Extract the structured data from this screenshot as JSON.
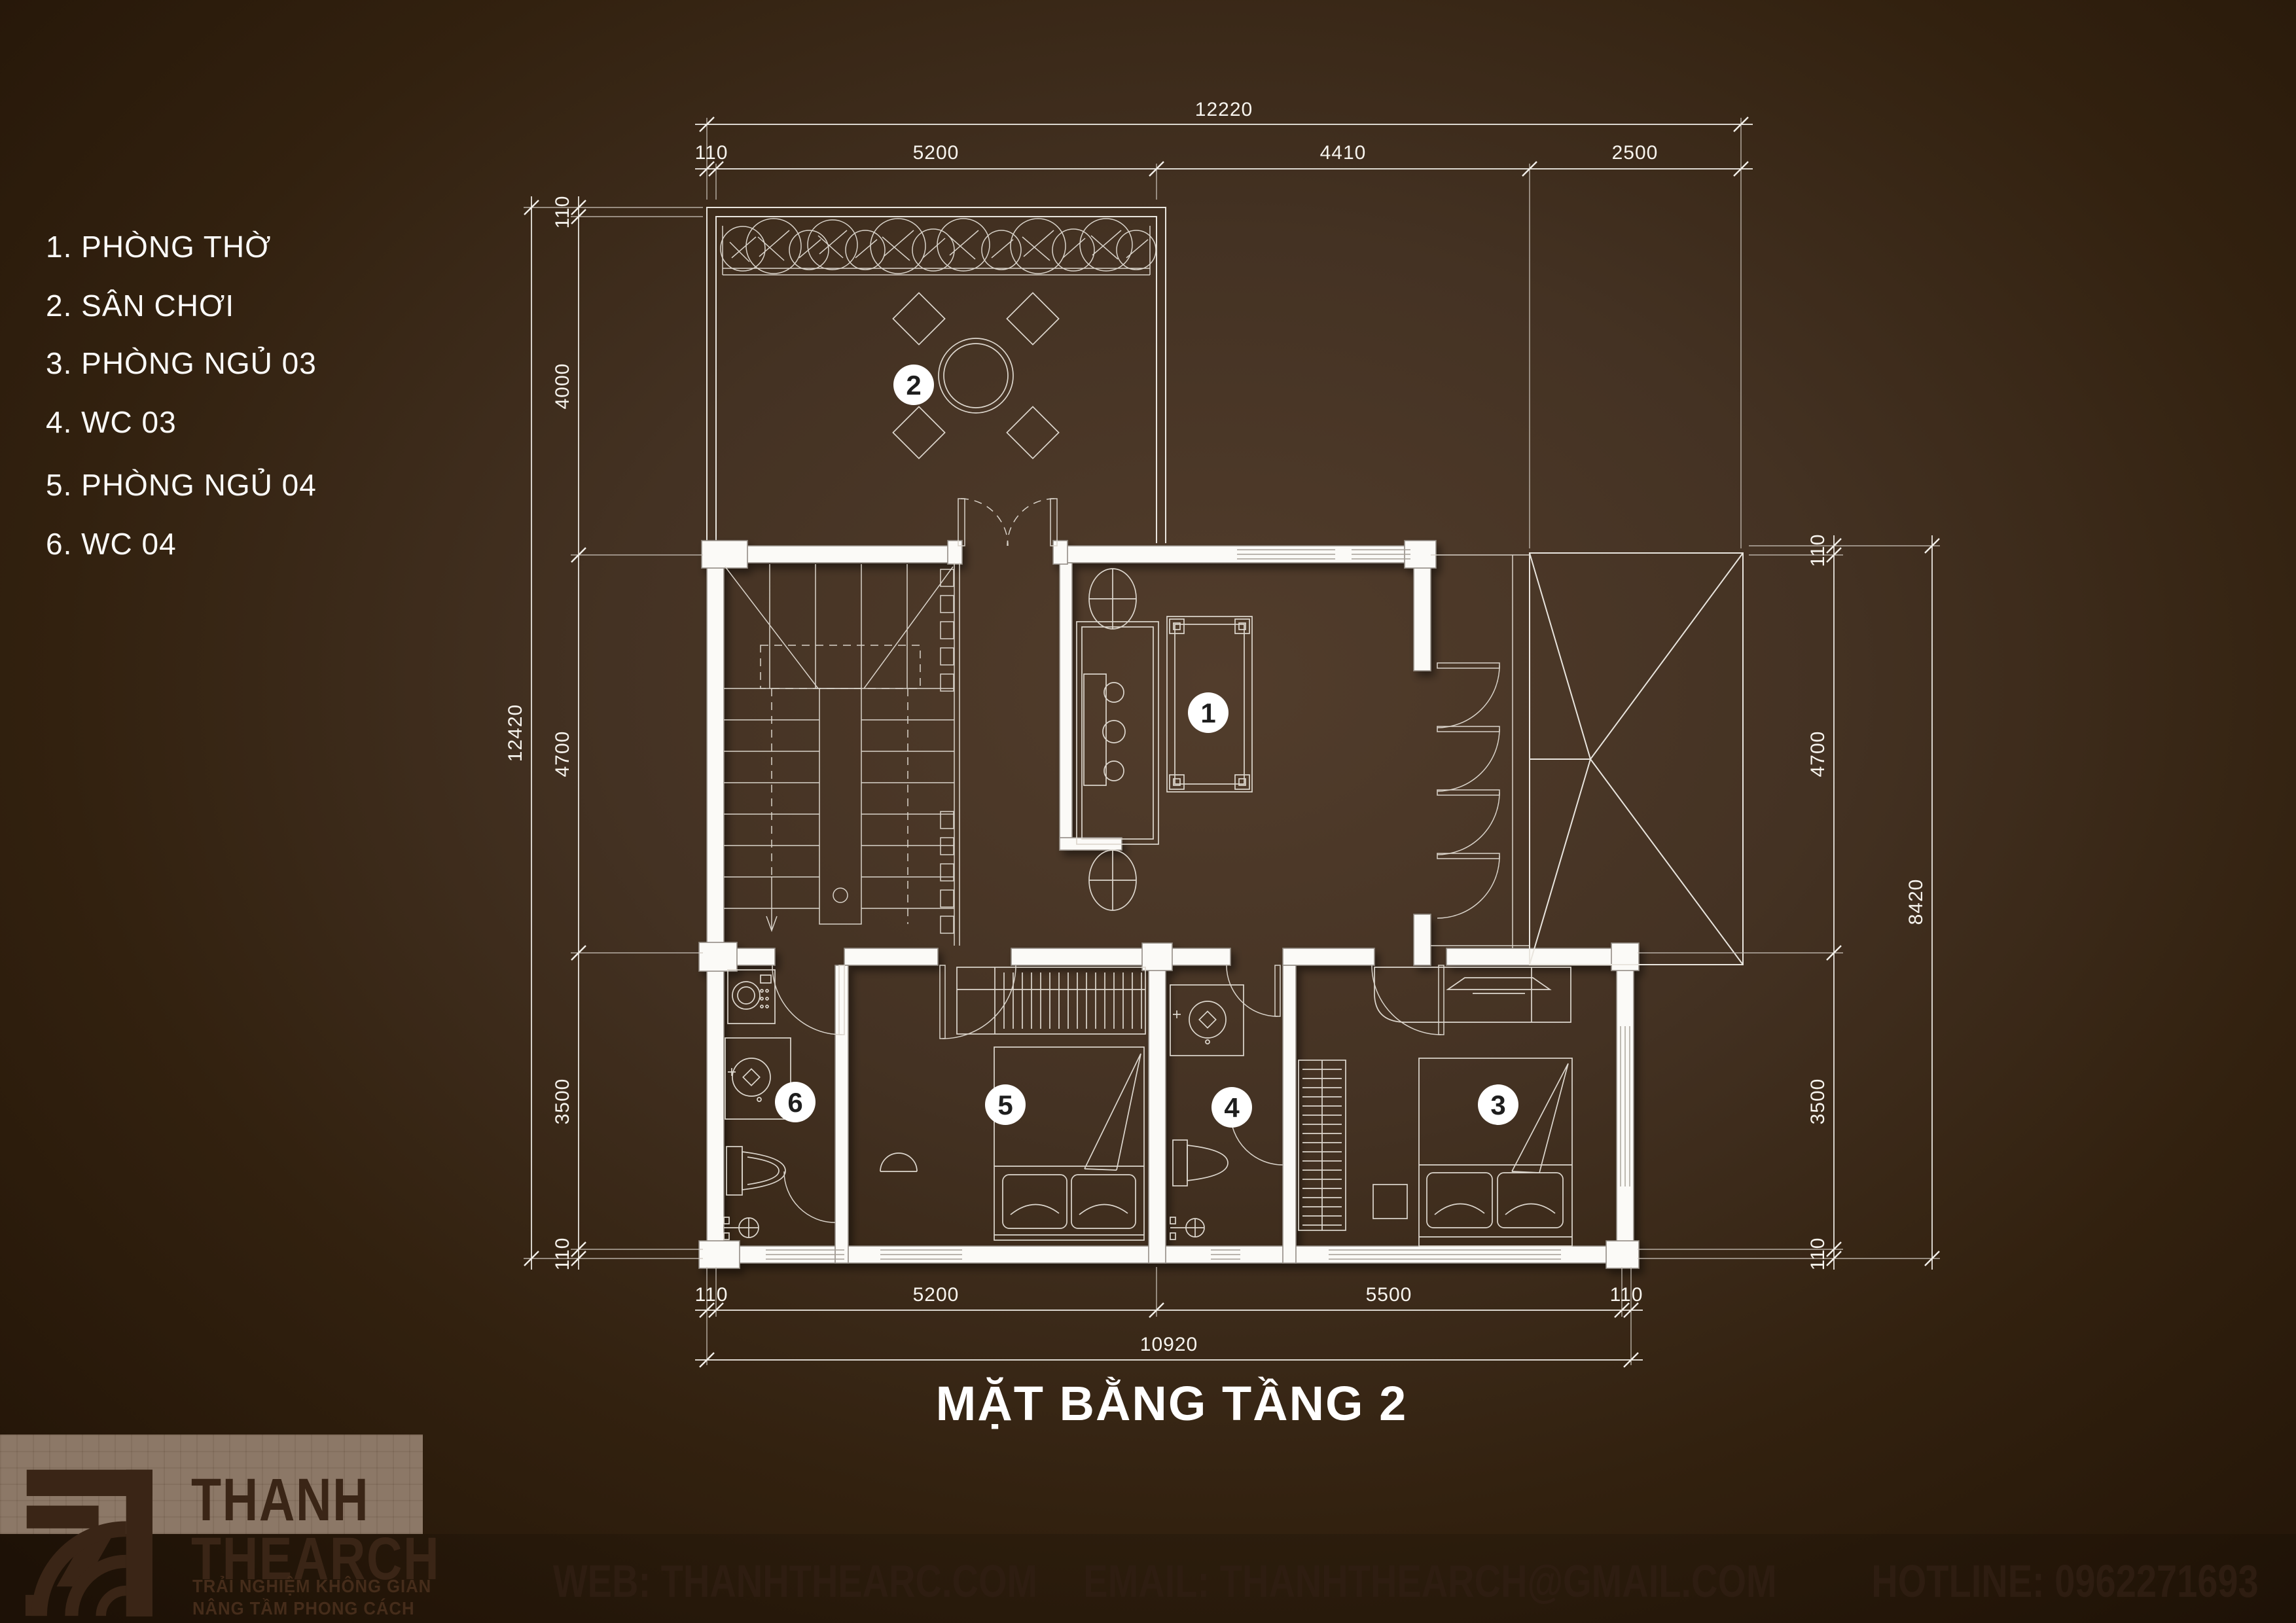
{
  "page": {
    "title": "MẶT BẰNG TẦNG 2"
  },
  "legend": {
    "items": [
      "1. PHÒNG THỜ",
      "2. SÂN CHƠI",
      "3. PHÒNG NGỦ 03",
      "4. WC 03",
      "5. PHÒNG NGỦ 04",
      "6. WC 04"
    ]
  },
  "badges": [
    "1",
    "2",
    "3",
    "4",
    "5",
    "6"
  ],
  "dimensions": {
    "top": {
      "total": "12220",
      "segments": [
        "110",
        "5200",
        "4410",
        "2500"
      ]
    },
    "bottom": {
      "total": "10920",
      "segments": [
        "110",
        "5200",
        "5500",
        "110"
      ]
    },
    "left": {
      "total": "12420",
      "segments": [
        "110",
        "4000",
        "4700",
        "3500",
        "110"
      ]
    },
    "right": {
      "total": "8420",
      "segments": [
        "110",
        "4700",
        "3500",
        "110"
      ]
    }
  },
  "footer": {
    "brand_line1": "THANH",
    "brand_line2": "THEARCH",
    "tagline_line1": "TRẢI NGHIỆM KHÔNG GIAN",
    "tagline_line2": "NÂNG TẦM PHONG CÁCH",
    "web": "WEB: THANHTHEARC.COM",
    "email": "EMAIL: THANHTHEARCH@GMAIL.COM",
    "hotline": "HOTLINE: 0962271693"
  },
  "colors": {
    "background_center": "#523d2c",
    "background_edge": "#221407",
    "plan_line": "#e9e5de",
    "wall_fill": "#fbfaf7",
    "logo_brown": "#3a2516",
    "footer_text": "#2e1d11",
    "logo_panel": "#8c7867"
  }
}
